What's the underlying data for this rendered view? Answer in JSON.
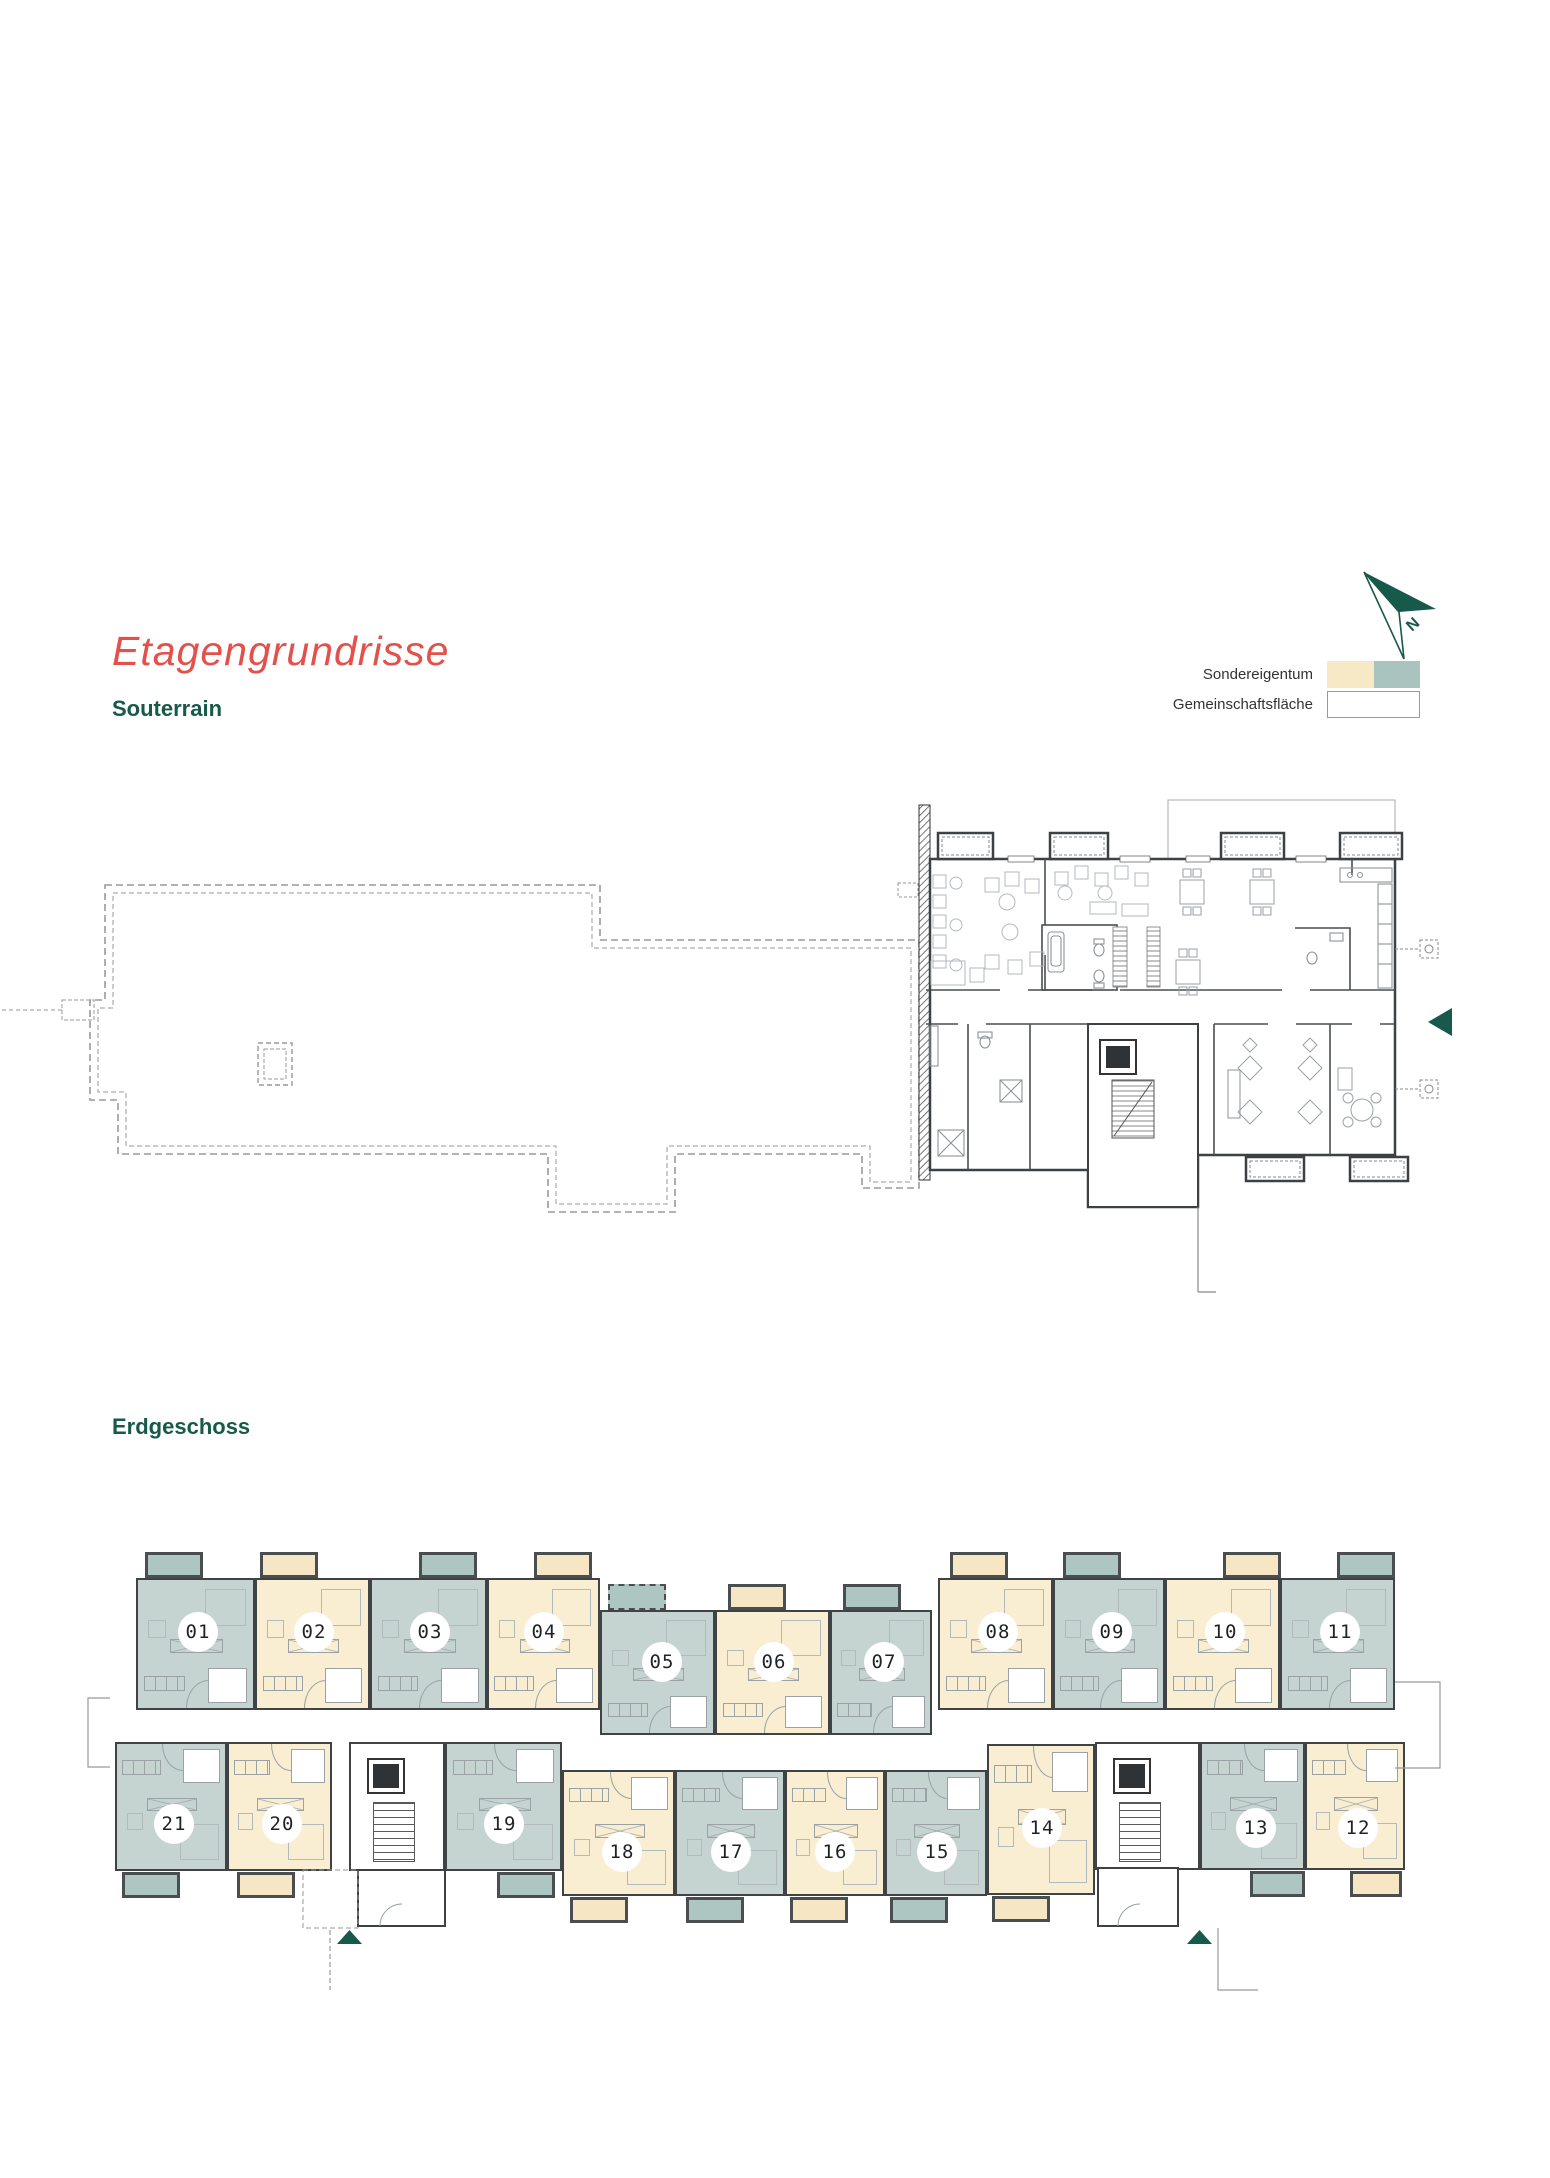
{
  "page": {
    "title": "Etagengrundrisse",
    "section1": "Souterrain",
    "section2": "Erdgeschoss"
  },
  "legend": {
    "rows": [
      {
        "label": "Sondereigentum",
        "swatches": [
          "legendBeige",
          "legendTeal"
        ]
      },
      {
        "label": "Gemeinschaftsfläche",
        "swatches": [
          "white"
        ]
      }
    ]
  },
  "north": {
    "label": "N"
  },
  "colors": {
    "titleRed": "#e4504b",
    "accent": "#17594a",
    "beige": "#f9edd2",
    "teal": "#c5d4d0",
    "balconyBeige": "#f6e6c4",
    "balconyTeal": "#adc6c1",
    "legendBeige": "#f7e8c6",
    "legendTeal": "#a9c3be",
    "white": "#ffffff",
    "wall": "#3f4345"
  },
  "erdgeschoss": {
    "units": [
      {
        "n": "01",
        "t": "t",
        "x": 136,
        "y": 1578,
        "w": 119,
        "h": 132,
        "cx": 196,
        "cy": 1630,
        "b": [
          145,
          1552,
          58,
          26
        ],
        "flip": false
      },
      {
        "n": "02",
        "t": "b",
        "x": 255,
        "y": 1578,
        "w": 115,
        "h": 132,
        "cx": 312,
        "cy": 1630,
        "b": [
          260,
          1552,
          58,
          26
        ],
        "flip": false
      },
      {
        "n": "03",
        "t": "t",
        "x": 370,
        "y": 1578,
        "w": 117,
        "h": 132,
        "cx": 428,
        "cy": 1630,
        "b": [
          419,
          1552,
          58,
          26
        ],
        "flip": false
      },
      {
        "n": "04",
        "t": "b",
        "x": 487,
        "y": 1578,
        "w": 113,
        "h": 132,
        "cx": 542,
        "cy": 1630,
        "b": [
          534,
          1552,
          58,
          26
        ],
        "flip": false
      },
      {
        "n": "05",
        "t": "t",
        "x": 600,
        "y": 1610,
        "w": 115,
        "h": 125,
        "cx": 660,
        "cy": 1660,
        "b": [
          608,
          1584,
          58,
          26
        ],
        "flip": false,
        "dashedBalcony": true
      },
      {
        "n": "06",
        "t": "b",
        "x": 715,
        "y": 1610,
        "w": 115,
        "h": 125,
        "cx": 772,
        "cy": 1660,
        "b": [
          728,
          1584,
          58,
          26
        ],
        "flip": false
      },
      {
        "n": "07",
        "t": "t",
        "x": 830,
        "y": 1610,
        "w": 102,
        "h": 125,
        "cx": 882,
        "cy": 1660,
        "b": [
          843,
          1584,
          58,
          26
        ],
        "flip": false
      },
      {
        "n": "08",
        "t": "b",
        "x": 938,
        "y": 1578,
        "w": 115,
        "h": 132,
        "cx": 996,
        "cy": 1630,
        "b": [
          950,
          1552,
          58,
          26
        ],
        "flip": false
      },
      {
        "n": "09",
        "t": "t",
        "x": 1053,
        "y": 1578,
        "w": 112,
        "h": 132,
        "cx": 1110,
        "cy": 1630,
        "b": [
          1063,
          1552,
          58,
          26
        ],
        "flip": false
      },
      {
        "n": "10",
        "t": "b",
        "x": 1165,
        "y": 1578,
        "w": 115,
        "h": 132,
        "cx": 1223,
        "cy": 1630,
        "b": [
          1223,
          1552,
          58,
          26
        ],
        "flip": false
      },
      {
        "n": "11",
        "t": "t",
        "x": 1280,
        "y": 1578,
        "w": 115,
        "h": 132,
        "cx": 1338,
        "cy": 1630,
        "b": [
          1337,
          1552,
          58,
          26
        ],
        "flip": false
      },
      {
        "n": "21",
        "t": "t",
        "x": 115,
        "y": 1742,
        "w": 112,
        "h": 129,
        "cx": 172,
        "cy": 1822,
        "b": [
          122,
          1872,
          58,
          26
        ],
        "flip": true
      },
      {
        "n": "20",
        "t": "b",
        "x": 227,
        "y": 1742,
        "w": 105,
        "h": 129,
        "cx": 280,
        "cy": 1822,
        "b": [
          237,
          1872,
          58,
          26
        ],
        "flip": true
      },
      {
        "n": "19",
        "t": "t",
        "x": 445,
        "y": 1742,
        "w": 117,
        "h": 129,
        "cx": 502,
        "cy": 1822,
        "b": [
          497,
          1872,
          58,
          26
        ],
        "flip": true
      },
      {
        "n": "18",
        "t": "b",
        "x": 562,
        "y": 1770,
        "w": 113,
        "h": 126,
        "cx": 620,
        "cy": 1850,
        "b": [
          570,
          1897,
          58,
          26
        ],
        "flip": true
      },
      {
        "n": "17",
        "t": "t",
        "x": 675,
        "y": 1770,
        "w": 110,
        "h": 126,
        "cx": 729,
        "cy": 1850,
        "b": [
          686,
          1897,
          58,
          26
        ],
        "flip": true
      },
      {
        "n": "16",
        "t": "b",
        "x": 785,
        "y": 1770,
        "w": 100,
        "h": 126,
        "cx": 833,
        "cy": 1850,
        "b": [
          790,
          1897,
          58,
          26
        ],
        "flip": true
      },
      {
        "n": "15",
        "t": "t",
        "x": 885,
        "y": 1770,
        "w": 102,
        "h": 126,
        "cx": 935,
        "cy": 1850,
        "b": [
          890,
          1897,
          58,
          26
        ],
        "flip": true
      },
      {
        "n": "14",
        "t": "b",
        "x": 987,
        "y": 1744,
        "w": 108,
        "h": 151,
        "cx": 1040,
        "cy": 1826,
        "b": [
          992,
          1896,
          58,
          26
        ],
        "flip": true
      },
      {
        "n": "13",
        "t": "t",
        "x": 1200,
        "y": 1742,
        "w": 105,
        "h": 128,
        "cx": 1254,
        "cy": 1826,
        "b": [
          1250,
          1871,
          55,
          26
        ],
        "flip": true
      },
      {
        "n": "12",
        "t": "b",
        "x": 1305,
        "y": 1742,
        "w": 100,
        "h": 128,
        "cx": 1356,
        "cy": 1826,
        "b": [
          1350,
          1871,
          52,
          26
        ],
        "flip": true
      }
    ],
    "stairwells": [
      {
        "x": 349,
        "y": 1742,
        "w": 96,
        "h": 129
      },
      {
        "x": 1095,
        "y": 1742,
        "w": 105,
        "h": 128
      }
    ]
  }
}
